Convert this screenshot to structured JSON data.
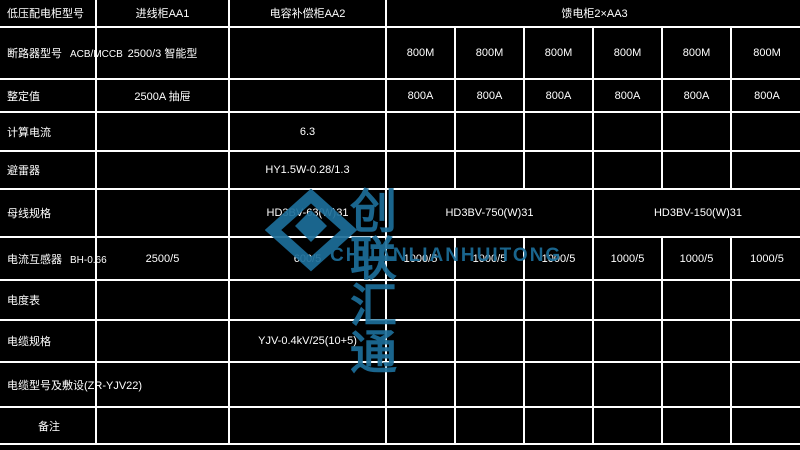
{
  "watermark": {
    "cn": "创联汇通",
    "en": "CHUANLIANHUITONG",
    "color": "#1d6e99",
    "logo": "nested-diamond-logo"
  },
  "table": {
    "header": {
      "c1": "低压配电柜型号",
      "c2": "进线柜AA1",
      "c3": "电容补偿柜AA2",
      "feeder": "馈电柜2×AA3"
    },
    "breaker": {
      "label": "断路器型号",
      "model": "ACB/MCCB",
      "incoming": "2500/3 智能型",
      "feed": [
        "800M",
        "800M",
        "800M",
        "800M",
        "800M",
        "800M"
      ]
    },
    "setting": {
      "label": "整定值",
      "incoming": "2500A 抽屉",
      "feed": [
        "800A",
        "800A",
        "800A",
        "800A",
        "800A",
        "800A"
      ]
    },
    "calc": {
      "label": "计算电流",
      "val": "6.3"
    },
    "arrester": {
      "label": "避雷器",
      "val": "HY1.5W-0.28/1.3"
    },
    "busbar": {
      "label": "母线规格",
      "v1": "HD3BV-63(W)31",
      "v2": "HD3BV-750(W)31",
      "v3": "HD3BV-150(W)31"
    },
    "ct": {
      "label": "电流互感器",
      "model": "BH-0.66",
      "incoming": "2500/5",
      "cap": "600/5",
      "feed": [
        "1000/5",
        "1000/5",
        "1000/5",
        "1000/5",
        "1000/5",
        "1000/5"
      ]
    },
    "meter": {
      "label": "电度表"
    },
    "cable": {
      "label": "电缆规格",
      "val": "YJV-0.4kV/25(10+5)"
    },
    "laying": {
      "label": "电缆型号及敷设(ZR-YJV22)"
    },
    "remark": {
      "label": "备注"
    }
  }
}
